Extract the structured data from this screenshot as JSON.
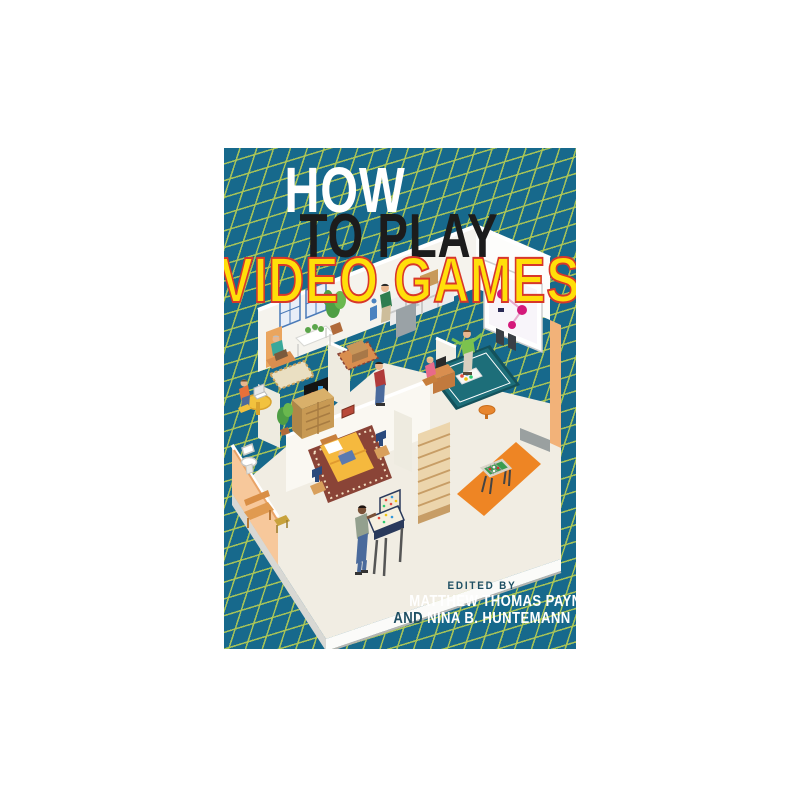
{
  "page": {
    "background": "#ffffff",
    "type": "book-cover product image"
  },
  "cover": {
    "background_color": "#17698c",
    "grid_line_color": "#aec755",
    "title": {
      "line1": "HOW",
      "line2": "TO PLAY",
      "line3": "VIDEO GAMES",
      "line1_color": "#ffffff",
      "line2_color": "#1c1c1c",
      "line3_fill": "#ffdf0a",
      "line3_outline": "#d8372a"
    },
    "credits": {
      "edited_by_label": "EDITED BY",
      "editor1": "MATTHEW THOMAS PAYNE",
      "and_label": "AND",
      "editor2": "NINA B. HUNTEMANN",
      "label_color": "#1e4f63",
      "name_color": "#ffffff"
    },
    "scene": {
      "description": "Isometric cutaway illustration of a one-story house on a teal drafting grid; people play video games in every room",
      "rooms": [
        "living room with armchair, console table, lattice windows, handheld player",
        "home office with round yellow table, laptop player",
        "bathroom with toilet",
        "media wall with dresser, TV and plant",
        "hallway with rug, chest and standing phone player",
        "kitchen with checkered backsplash and stove",
        "game room with teal rug, wall TV, speakers, dance-mat player and desk player",
        "bedroom with bed, handheld player, nightstands and lamps",
        "deck with orange floor and foosball table",
        "staircase",
        "front patio with bench, side table and pinball machine player"
      ],
      "people_count": 8
    }
  }
}
